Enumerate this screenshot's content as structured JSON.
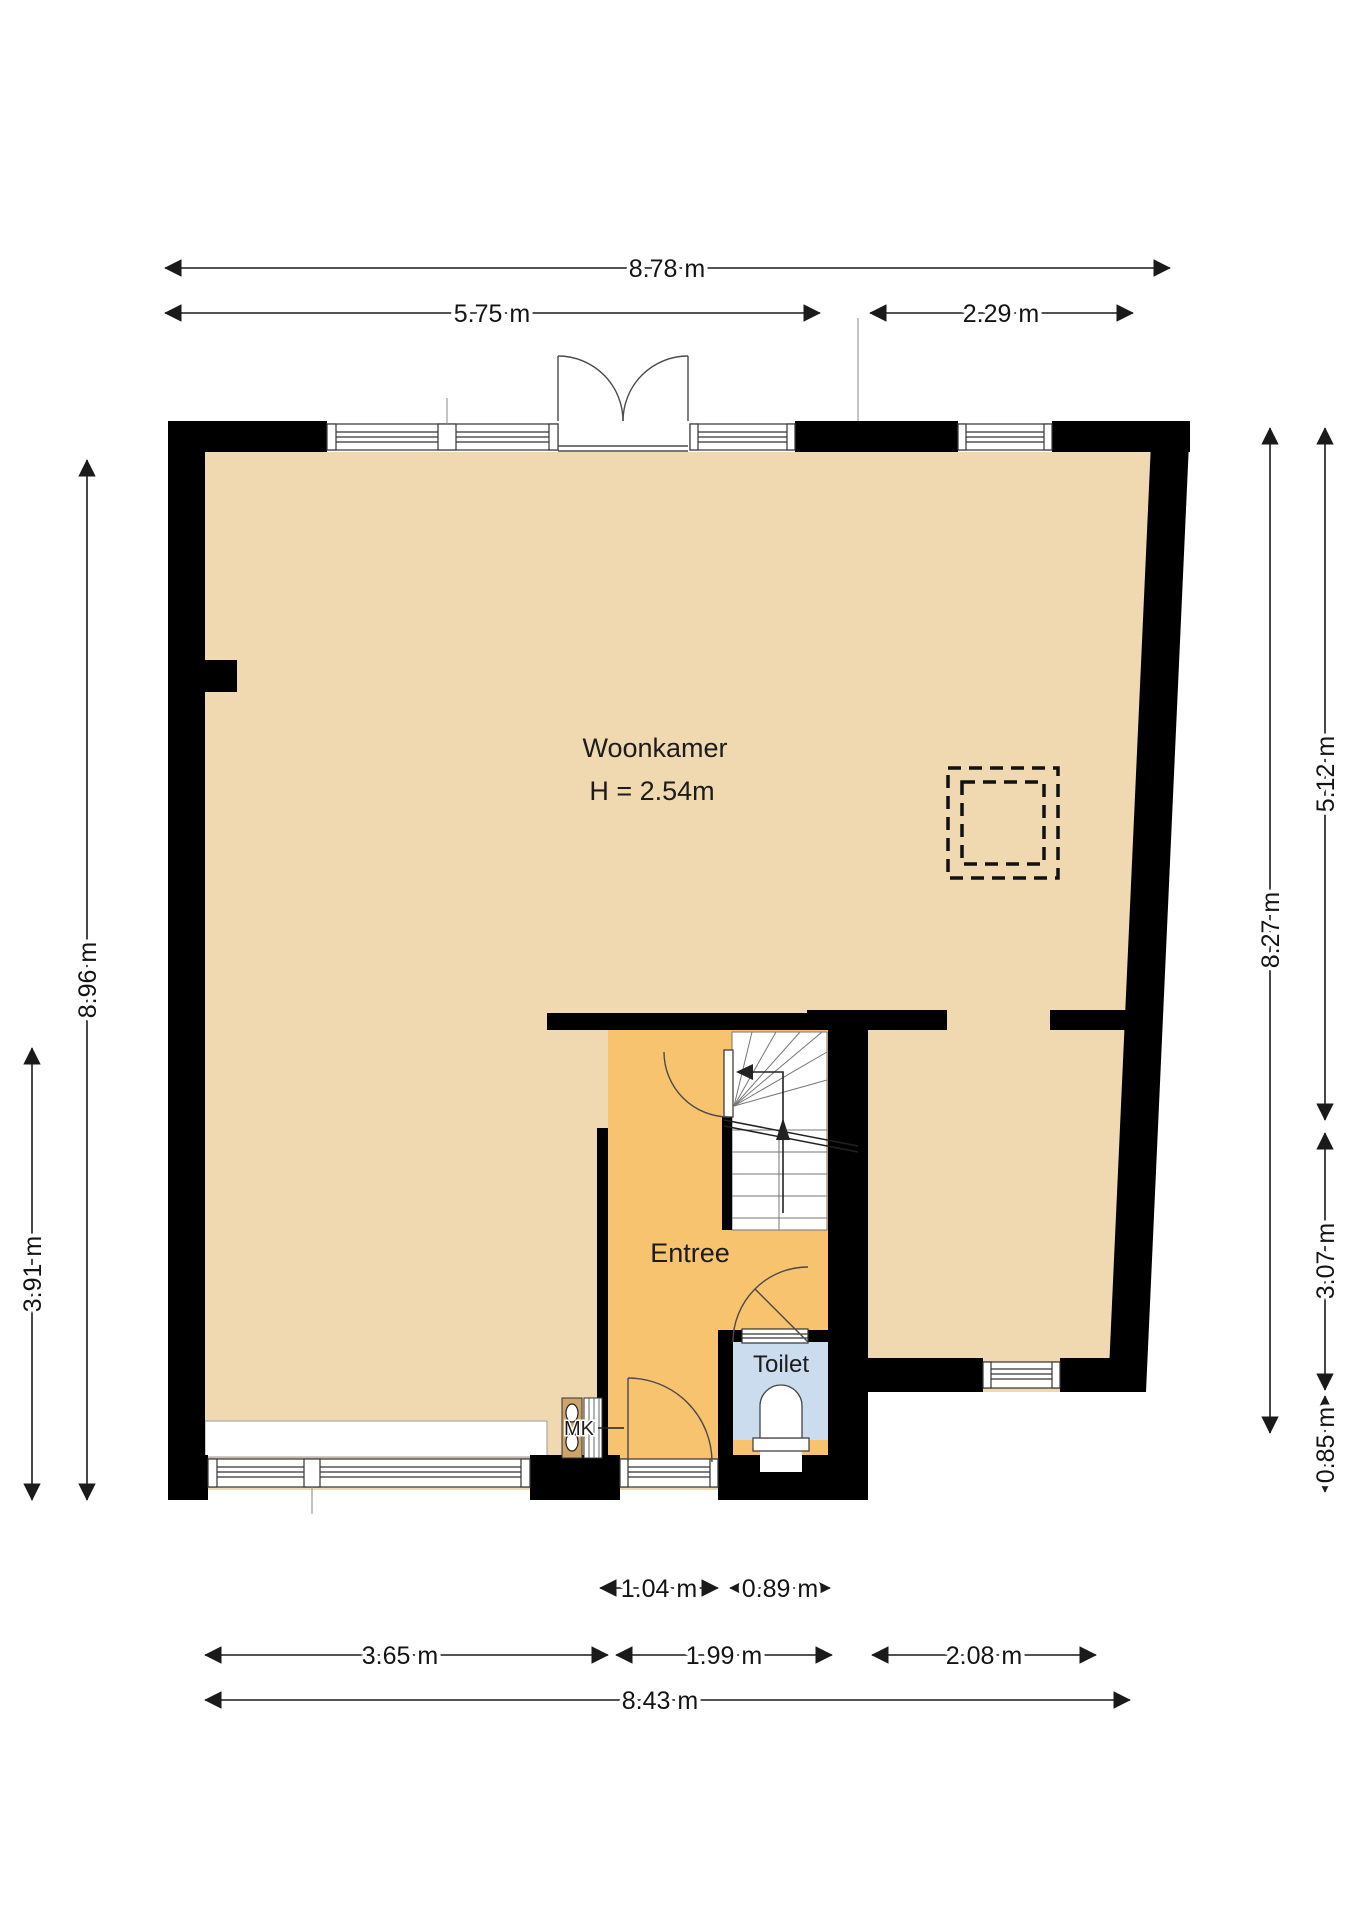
{
  "rooms": {
    "woonkamer": {
      "label": "Woonkamer",
      "height": "H = 2.54m"
    },
    "entree": {
      "label": "Entree"
    },
    "toilet": {
      "label": "Toilet"
    },
    "meterkast": {
      "label": "MK"
    }
  },
  "dimensions": {
    "top_total": "8.78 m",
    "top_left": "5.75 m",
    "top_right": "2.29 m",
    "left_full": "8.96 m",
    "left_lower": "3.91 m",
    "right_full": "8.27 m",
    "right_upper": "5.12 m",
    "right_lower": "3.07 m",
    "right_bottom": "0.85 m",
    "bottom_door": "1.04 m",
    "bottom_toilet": "0.89 m",
    "bottom_left": "3.65 m",
    "bottom_middle": "1.99 m",
    "bottom_right": "2.08 m",
    "bottom_total": "8.43 m"
  },
  "colors": {
    "wall": "#000000",
    "floor_living": "#F0D9B1",
    "floor_entree": "#F8C36E",
    "floor_toilet": "#CBDCEE",
    "cabinet": "#CDA46B",
    "background": "#FFFFFF"
  }
}
